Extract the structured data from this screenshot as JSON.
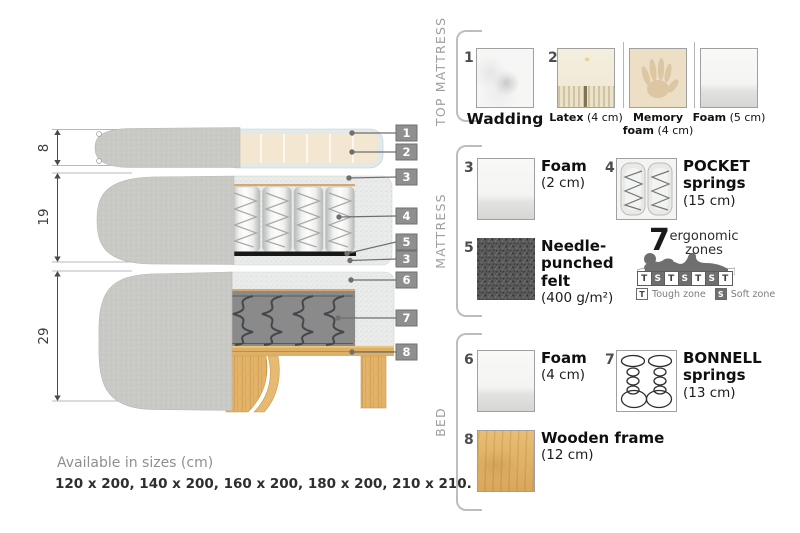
{
  "diagram": {
    "dims": {
      "top_mattress": "8",
      "mattress": "19",
      "bed": "29"
    },
    "callouts": [
      {
        "n": "1"
      },
      {
        "n": "2"
      },
      {
        "n": "3"
      },
      {
        "n": "4"
      },
      {
        "n": "5"
      },
      {
        "n": "3"
      },
      {
        "n": "6"
      },
      {
        "n": "7"
      },
      {
        "n": "8"
      }
    ],
    "sizes_title": "Available in sizes (cm)",
    "sizes_list": "120 x 200, 140 x 200, 160 x 200, 180 x 200, 210 x 210."
  },
  "panel": {
    "top_mattress": {
      "label": "TOP MATTRESS",
      "items": [
        {
          "num": "1",
          "name": "Wadding",
          "size": ""
        },
        {
          "num": "2",
          "name": "Latex",
          "size": "(4 cm)"
        },
        {
          "num": "",
          "name": "Memory foam",
          "size": "(4 cm)"
        },
        {
          "num": "",
          "name": "Foam",
          "size": "(5 cm)"
        }
      ]
    },
    "mattress": {
      "label": "MATTRESS",
      "items": [
        {
          "num": "3",
          "name": "Foam",
          "size": "(2 cm)"
        },
        {
          "num": "4",
          "name": "POCKET springs",
          "size": "(15 cm)"
        },
        {
          "num": "5",
          "name": "Needle-punched felt",
          "size": "(400 g/m²)"
        }
      ],
      "zones": {
        "count": "7",
        "label": "ergonomic zones",
        "boxes": [
          "T",
          "S",
          "T",
          "S",
          "T",
          "S",
          "T"
        ],
        "tough_key": "T",
        "tough_label": "Tough zone",
        "soft_key": "S",
        "soft_label": "Soft zone"
      }
    },
    "bed": {
      "label": "BED",
      "items": [
        {
          "num": "6",
          "name": "Foam",
          "size": "(4 cm)"
        },
        {
          "num": "7",
          "name": "BONNELL springs",
          "size": "(13 cm)"
        },
        {
          "num": "8",
          "name": "Wooden frame",
          "size": "(12 cm)"
        }
      ]
    }
  },
  "colors": {
    "badge": "#8f8f8f",
    "fabric": "#c9c9c5",
    "foam_speckle": "#eaecec",
    "latex": "#f3e7d2",
    "wood": "#e0b267",
    "felt": "#565656",
    "zone_dark": "#6f6f6f",
    "accent_tan": "#d8a770"
  }
}
